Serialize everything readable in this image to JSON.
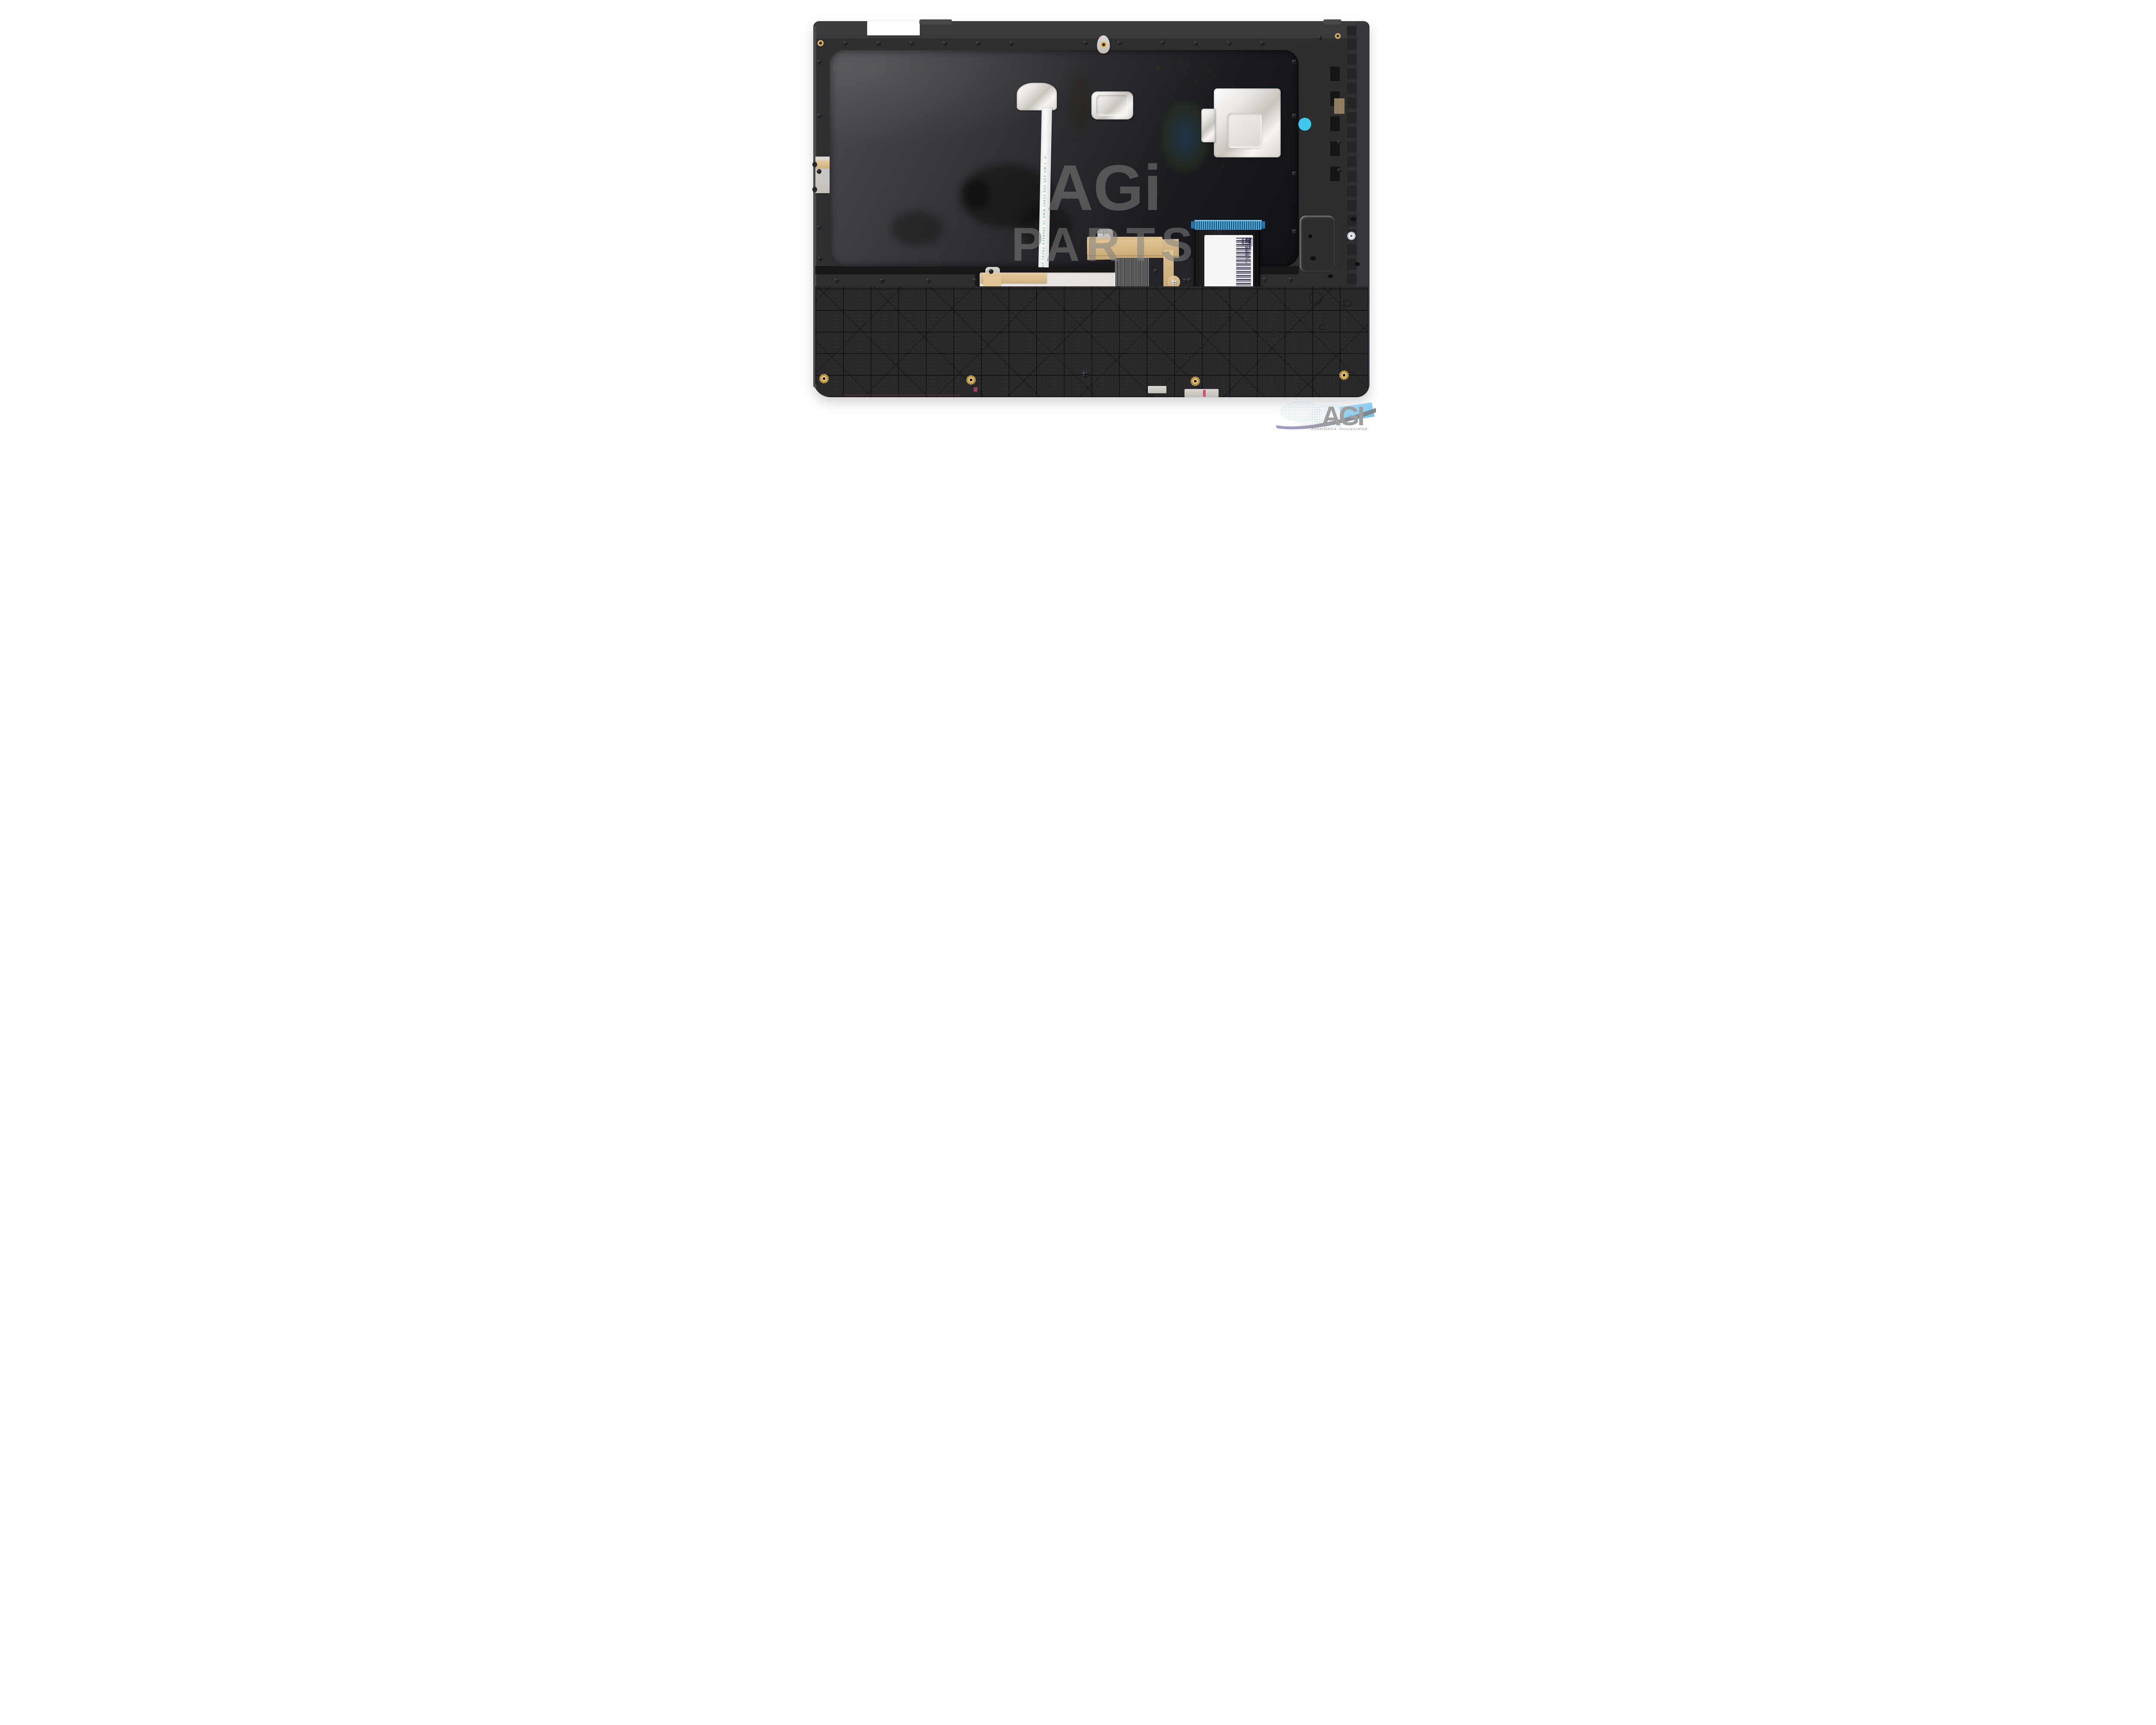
{
  "watermark": {
    "line1": "AGi",
    "line2": "PARTS"
  },
  "brand_logo": {
    "acronym": "AGI",
    "company": "AssetGenie Incorporated"
  },
  "labels": {
    "date_label": {
      "line1": "JING.JIE",
      "line2": "JDX.2017.8.20"
    },
    "serial_label": {
      "part_number": "8S1102-02670",
      "serial": "JJHF7C40177",
      "variant": "Flex11-UK C11"
    },
    "cable_label": {
      "line1_left": "BLT P/N:1204-02073",
      "line1_right": "REV.:MP-0A",
      "line2_left": "CNY P/N:LCM16K66CU-6861",
      "line2_right": "REV.:0A",
      "line3_left": "Lenovo P/N:",
      "line3_right": "Model No:LCM16K6",
      "serial": "8S1204-02073C1007AB0FEJ",
      "origin": "Made in China",
      "cert": "UL"
    },
    "sticker_serial": "S7726095B",
    "touchpad_label": "SA461D-2002",
    "flex_marking_long": "HF   TATSU E308092 3L AWM 20624 80C 60V VW-1 -F-",
    "flex_marking_short": "TATSU E308092",
    "molded_text": "N25 C Cover UK"
  },
  "colors": {
    "cyan_sticker": "#3ec9ea",
    "kapton_tape": "#d9c298",
    "touchpad_pcb": "#5d8f5c",
    "connector_blue": "#2e7fae",
    "brass": "#c9a050",
    "silver_plate": "#d8d4cc",
    "plastic_dark": "#2a2b2d"
  }
}
